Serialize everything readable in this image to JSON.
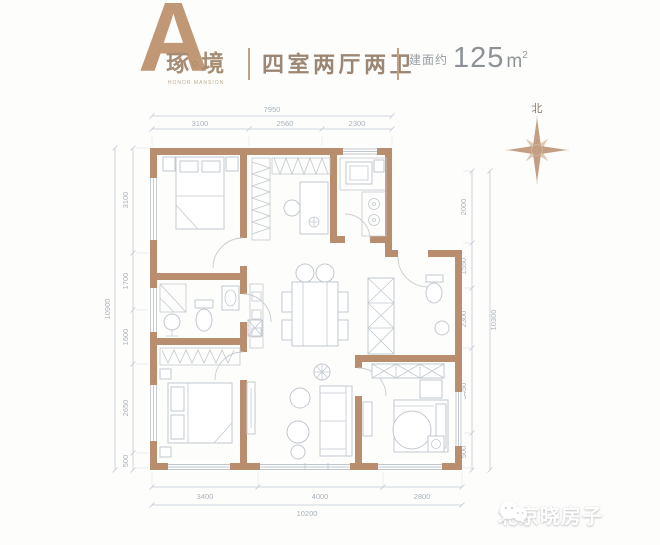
{
  "header": {
    "brand_letter": "A",
    "brand_name": "琢◦境",
    "brand_sub": "HONOR MANSION",
    "layout_label": "四室两厅两卫",
    "area_prefix": "建面约",
    "area_value": "125",
    "area_unit": "m",
    "area_exponent": "2"
  },
  "compass": {
    "north_label": "北",
    "icon": "compass-rose-icon"
  },
  "floorplan": {
    "dimensions": {
      "top": {
        "total": "7950",
        "segments": [
          "3100",
          "2560",
          "2300"
        ]
      },
      "bottom": {
        "total": "10200",
        "segments": [
          "3400",
          "4000",
          "2800"
        ]
      },
      "left": {
        "total": "10900",
        "segments": [
          "3100",
          "1700",
          "1600",
          "2650",
          "500"
        ]
      },
      "right": {
        "total": "10300",
        "segments": [
          "2000",
          "1550",
          "2300",
          "3450",
          "500"
        ]
      }
    }
  },
  "watermark": {
    "icon": "wechat-icon",
    "text": "北京晓房子"
  },
  "colors": {
    "wall": "#b98e6e",
    "accent_tan": "#c19876",
    "text_brown": "#9c8774",
    "text_gray": "#8d9296",
    "dim_line": "#c2cad1",
    "dim_text": "#a9b3bb",
    "furniture_line": "#c3c9cf"
  }
}
